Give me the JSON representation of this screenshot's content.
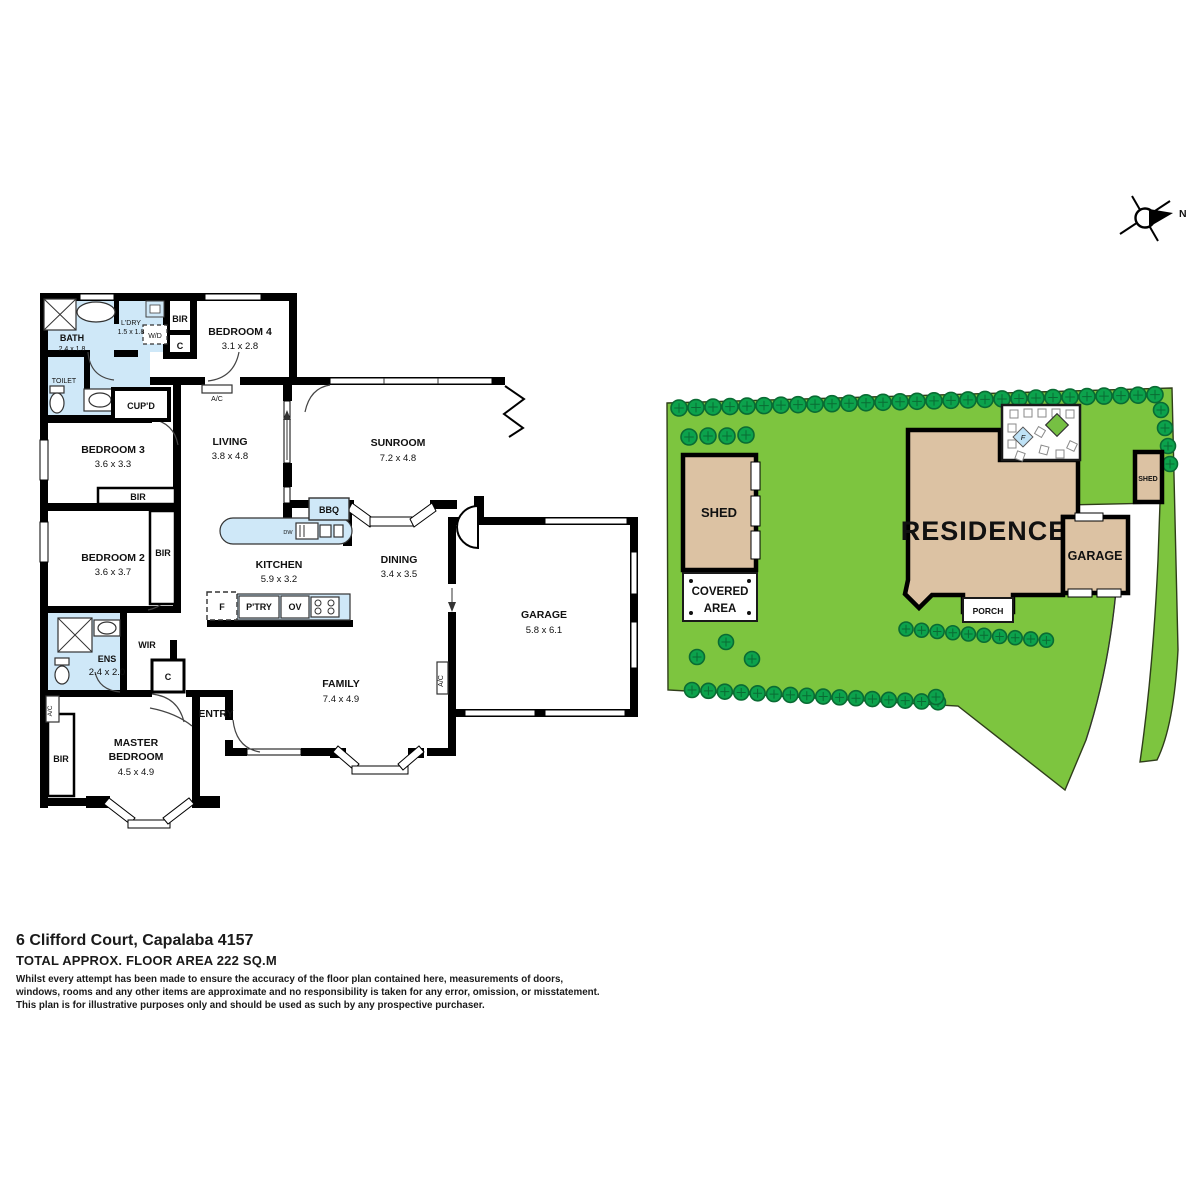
{
  "floorplan": {
    "bath": {
      "name": "BATH",
      "dims": "2.4 x 1.8"
    },
    "ldry": {
      "name": "L'DRY",
      "dims": "1.5 x 1.8"
    },
    "wd": "W/D",
    "bir": "BIR",
    "c": "C",
    "bed4": {
      "name": "BEDROOM 4",
      "dims": "3.1 x 2.8"
    },
    "ac": "A/C",
    "toilet": "TOILET",
    "cupd": "CUP'D",
    "bed3": {
      "name": "BEDROOM 3",
      "dims": "3.6 x 3.3"
    },
    "living": {
      "name": "LIVING",
      "dims": "3.8 x 4.8"
    },
    "sunroom": {
      "name": "SUNROOM",
      "dims": "7.2 x 4.8"
    },
    "bed2": {
      "name": "BEDROOM 2",
      "dims": "3.6 x 3.7"
    },
    "bbq": "BBQ",
    "dw": "DW",
    "kitchen": {
      "name": "KITCHEN",
      "dims": "5.9 x 3.2"
    },
    "dining": {
      "name": "DINING",
      "dims": "3.4 x 3.5"
    },
    "garage": {
      "name": "GARAGE",
      "dims": "5.8 x 6.1"
    },
    "ens": {
      "name": "ENS",
      "dims": "2.4 x 2.0"
    },
    "wir": "WIR",
    "f": "F",
    "ptry": "P'TRY",
    "ov": "OV",
    "family": {
      "name": "FAMILY",
      "dims": "7.4 x 4.9"
    },
    "entry": "ENTRY",
    "master": {
      "line1": "MASTER",
      "line2": "BEDROOM",
      "dims": "4.5 x 4.9"
    }
  },
  "siteplan": {
    "residence": "RESIDENCE",
    "garage": "GARAGE",
    "shed": "SHED",
    "shed_small": "SHED",
    "covered_line1": "COVERED",
    "covered_line2": "AREA",
    "porch": "PORCH",
    "fountain": "F"
  },
  "compass": {
    "north": "N"
  },
  "footer": {
    "address": "6 Clifford Court, Capalaba 4157",
    "area": "TOTAL APPROX. FLOOR AREA 222 SQ.M",
    "disclaimer_line1": "Whilst every attempt has been made to ensure the accuracy of the floor plan contained here, measurements of doors,",
    "disclaimer_line2": "windows, rooms and any other items are approximate and no responsibility is taken for any error, omission, or misstatement.",
    "disclaimer_line3": "This plan is for illustrative purposes only and should be used as such by any prospective purchaser."
  },
  "colors": {
    "lawn": "#7dc53f",
    "tree": "#0ca24c",
    "building_tan": "#dcc2a3",
    "wet_area_blue": "#cfe8f8",
    "wall": "#000000"
  }
}
